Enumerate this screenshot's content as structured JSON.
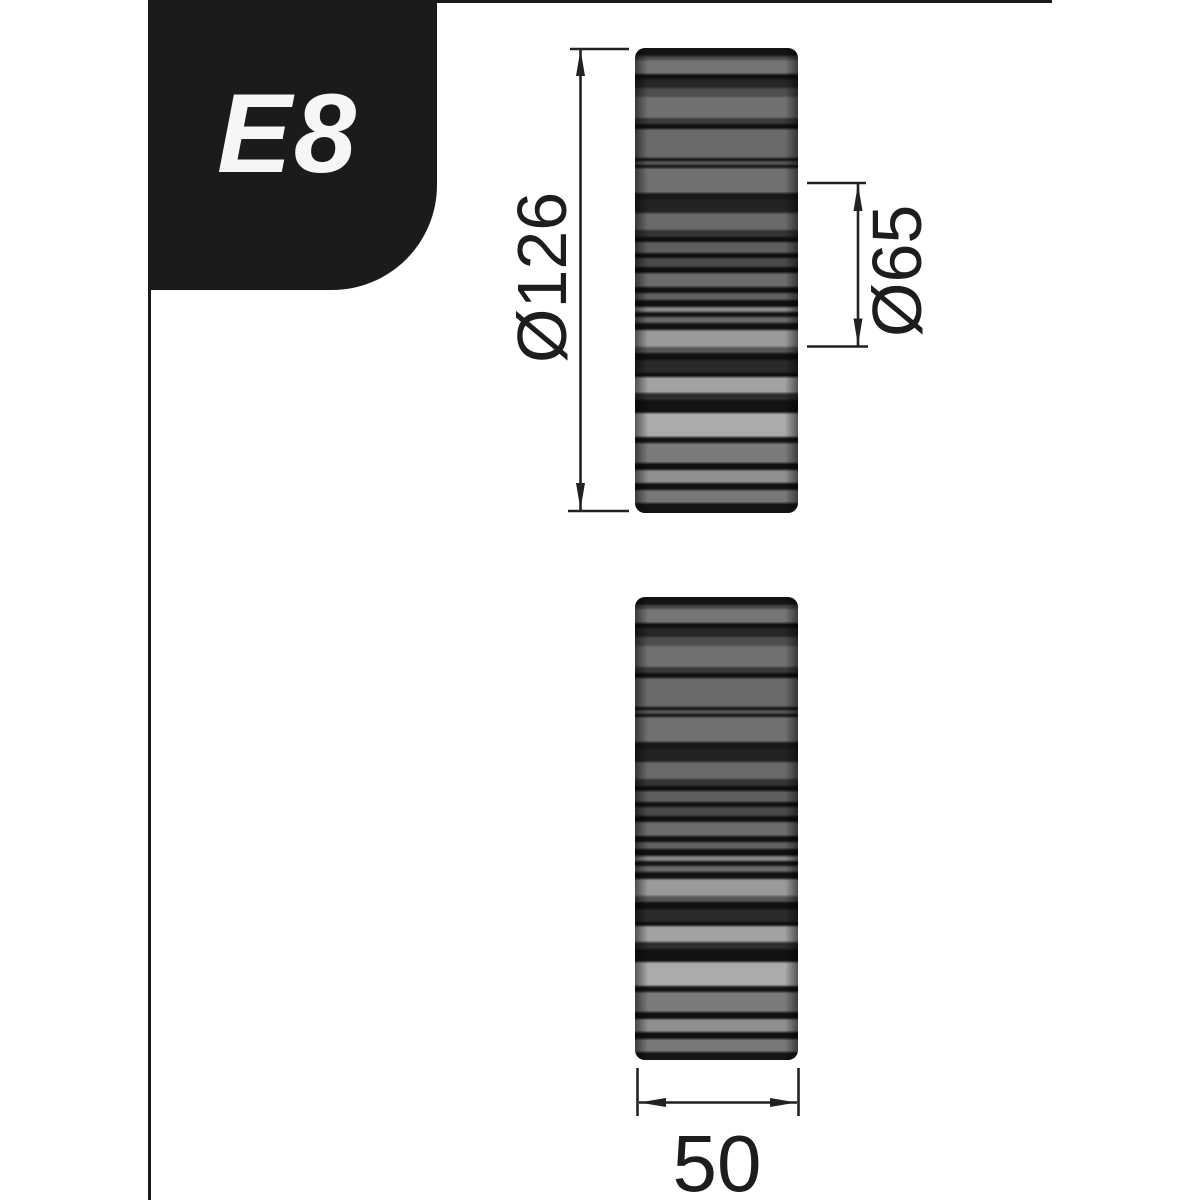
{
  "badge": {
    "label": "E8"
  },
  "dimensions": {
    "outer_diameter": {
      "label": "Ø126",
      "value": 126
    },
    "hub_diameter": {
      "label": "Ø65",
      "value": 65
    },
    "width": {
      "label": "50",
      "value": 50
    }
  },
  "colors": {
    "background": "#ffffff",
    "badge_bg": "#1b1b1d",
    "badge_fg": "#f6f6f4",
    "frame_line": "#1a1a1a",
    "dim_line": "#222222",
    "dim_text": "#1d1d1d"
  },
  "roller": {
    "views": 2,
    "stripes": [
      [
        8,
        "#141414"
      ],
      [
        4,
        "#4a4a4a"
      ],
      [
        14,
        "#757575"
      ],
      [
        5,
        "#101010"
      ],
      [
        9,
        "#262626"
      ],
      [
        9,
        "#4e4e4e"
      ],
      [
        21,
        "#717171"
      ],
      [
        6,
        "#3a3a3a"
      ],
      [
        5,
        "#0f0f0f"
      ],
      [
        29,
        "#6a6a6a"
      ],
      [
        3,
        "#111111"
      ],
      [
        4,
        "#565656"
      ],
      [
        3,
        "#111111"
      ],
      [
        25,
        "#707070"
      ],
      [
        7,
        "#191919"
      ],
      [
        13,
        "#232323"
      ],
      [
        17,
        "#6a6a6a"
      ],
      [
        7,
        "#343434"
      ],
      [
        5,
        "#0f0f0f"
      ],
      [
        11,
        "#5f5f5f"
      ],
      [
        5,
        "#101010"
      ],
      [
        9,
        "#4a4a4a"
      ],
      [
        6,
        "#0f0f0f"
      ],
      [
        14,
        "#6d6d6d"
      ],
      [
        6,
        "#111111"
      ],
      [
        7,
        "#616161"
      ],
      [
        7,
        "#101010"
      ],
      [
        5,
        "#8a8a8a"
      ],
      [
        5,
        "#151515"
      ],
      [
        6,
        "#6a6a6a"
      ],
      [
        7,
        "#121212"
      ],
      [
        17,
        "#9a9a9a"
      ],
      [
        6,
        "#555555"
      ],
      [
        7,
        "#0f0f0f"
      ],
      [
        13,
        "#2a2a2a"
      ],
      [
        4,
        "#0e0e0e"
      ],
      [
        16,
        "#a2a2a2"
      ],
      [
        7,
        "#2e2e2e"
      ],
      [
        13,
        "#121212"
      ],
      [
        24,
        "#ababab"
      ],
      [
        6,
        "#131313"
      ],
      [
        20,
        "#7a7a7a"
      ],
      [
        7,
        "#101010"
      ],
      [
        13,
        "#8f8f8f"
      ],
      [
        7,
        "#111111"
      ],
      [
        13,
        "#787878"
      ],
      [
        10,
        "#141414"
      ]
    ]
  }
}
